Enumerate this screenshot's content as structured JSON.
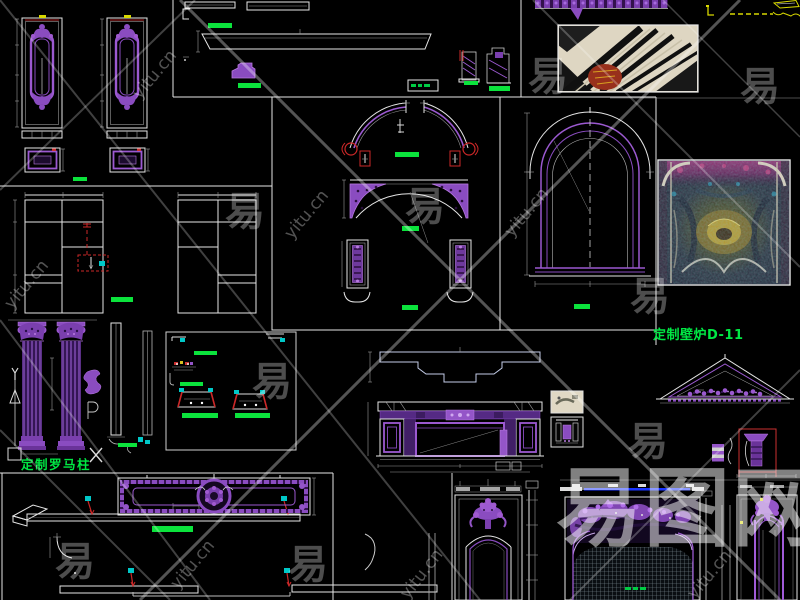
{
  "canvas": {
    "width": 800,
    "height": 600,
    "background": "#000000"
  },
  "labels": {
    "fireplace_custom": "定制壁炉D-11",
    "roman_column_custom": "定制罗马柱"
  },
  "watermark": {
    "site_text": "yitu.cn",
    "glyph": "易",
    "brand": "易图网"
  },
  "colors": {
    "linework": "#e6e6e6",
    "ornament_purple": "#9b59d0",
    "ornament_deep": "#7a3fae",
    "dimension_green": "#0be33c",
    "label_green": "#00e844",
    "marker_red": "#cc2828",
    "marker_cyan": "#00c8c8",
    "marker_yellow": "#d8d800",
    "axis_blue": "#1a35ff"
  }
}
